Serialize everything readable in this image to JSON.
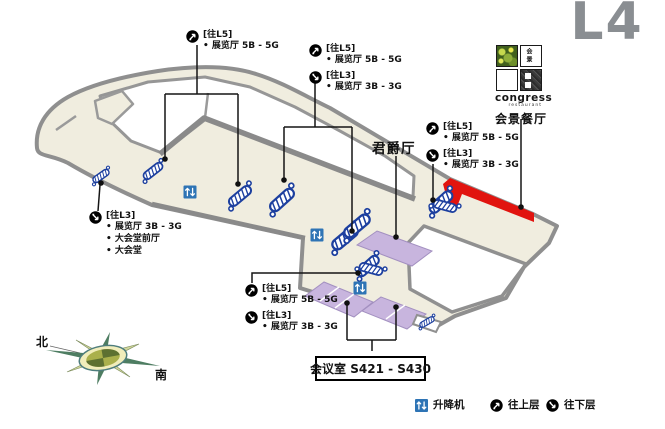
{
  "title": {
    "level": "L4"
  },
  "map": {
    "rooms": {
      "chancellor_label": "君爵厅",
      "meeting_box_label": "会议室 S421 - S430"
    },
    "restaurant": {
      "logo": "congress",
      "logo_sub": "restaurant",
      "logo_tiny_chars": "会 景",
      "name": "会景餐厅"
    }
  },
  "callouts": {
    "top_left": {
      "entries": [
        {
          "icon": "up-level-icon",
          "tag": "[往L5]",
          "items": [
            "• 展览厅 5B - 5G"
          ]
        }
      ]
    },
    "top_mid": {
      "entries": [
        {
          "icon": "up-level-icon",
          "tag": "[往L5]",
          "items": [
            "• 展览厅 5B - 5G"
          ]
        },
        {
          "icon": "down-level-icon",
          "tag": "[往L3]",
          "items": [
            "• 展览厅 3B - 3G"
          ]
        }
      ]
    },
    "right": {
      "entries": [
        {
          "icon": "up-level-icon",
          "tag": "[往L5]",
          "items": [
            "• 展览厅 5B - 5G"
          ]
        },
        {
          "icon": "down-level-icon",
          "tag": "[往L3]",
          "items": [
            "• 展览厅 3B - 3G"
          ]
        }
      ]
    },
    "left": {
      "entries": [
        {
          "icon": "down-level-icon",
          "tag": "[往L3]",
          "items": [
            "• 展览厅 3B - 3G",
            "• 大会堂前厅",
            "• 大会堂"
          ]
        }
      ]
    },
    "bottom": {
      "entries": [
        {
          "icon": "up-level-icon",
          "tag": "[往L5]",
          "items": [
            "• 展览厅 5B - 5G"
          ]
        },
        {
          "icon": "down-level-icon",
          "tag": "[往L3]",
          "items": [
            "• 展览厅 3B - 3G"
          ]
        }
      ]
    }
  },
  "legend": {
    "elevator": "升降机",
    "up": "往上层",
    "down": "往下层"
  },
  "compass": {
    "north": "北",
    "south": "南"
  },
  "colors": {
    "building_fill": "#f0eddf",
    "outline_gray": "#8f8f8f",
    "wall_gray": "#8a8a8a",
    "restaurant_red": "#e1140f",
    "room_purple": "#c8b5de",
    "escalator_blue": "#1c3f9f",
    "elevator_blue": "#2e74b5",
    "title_gray": "#8a8e92"
  }
}
